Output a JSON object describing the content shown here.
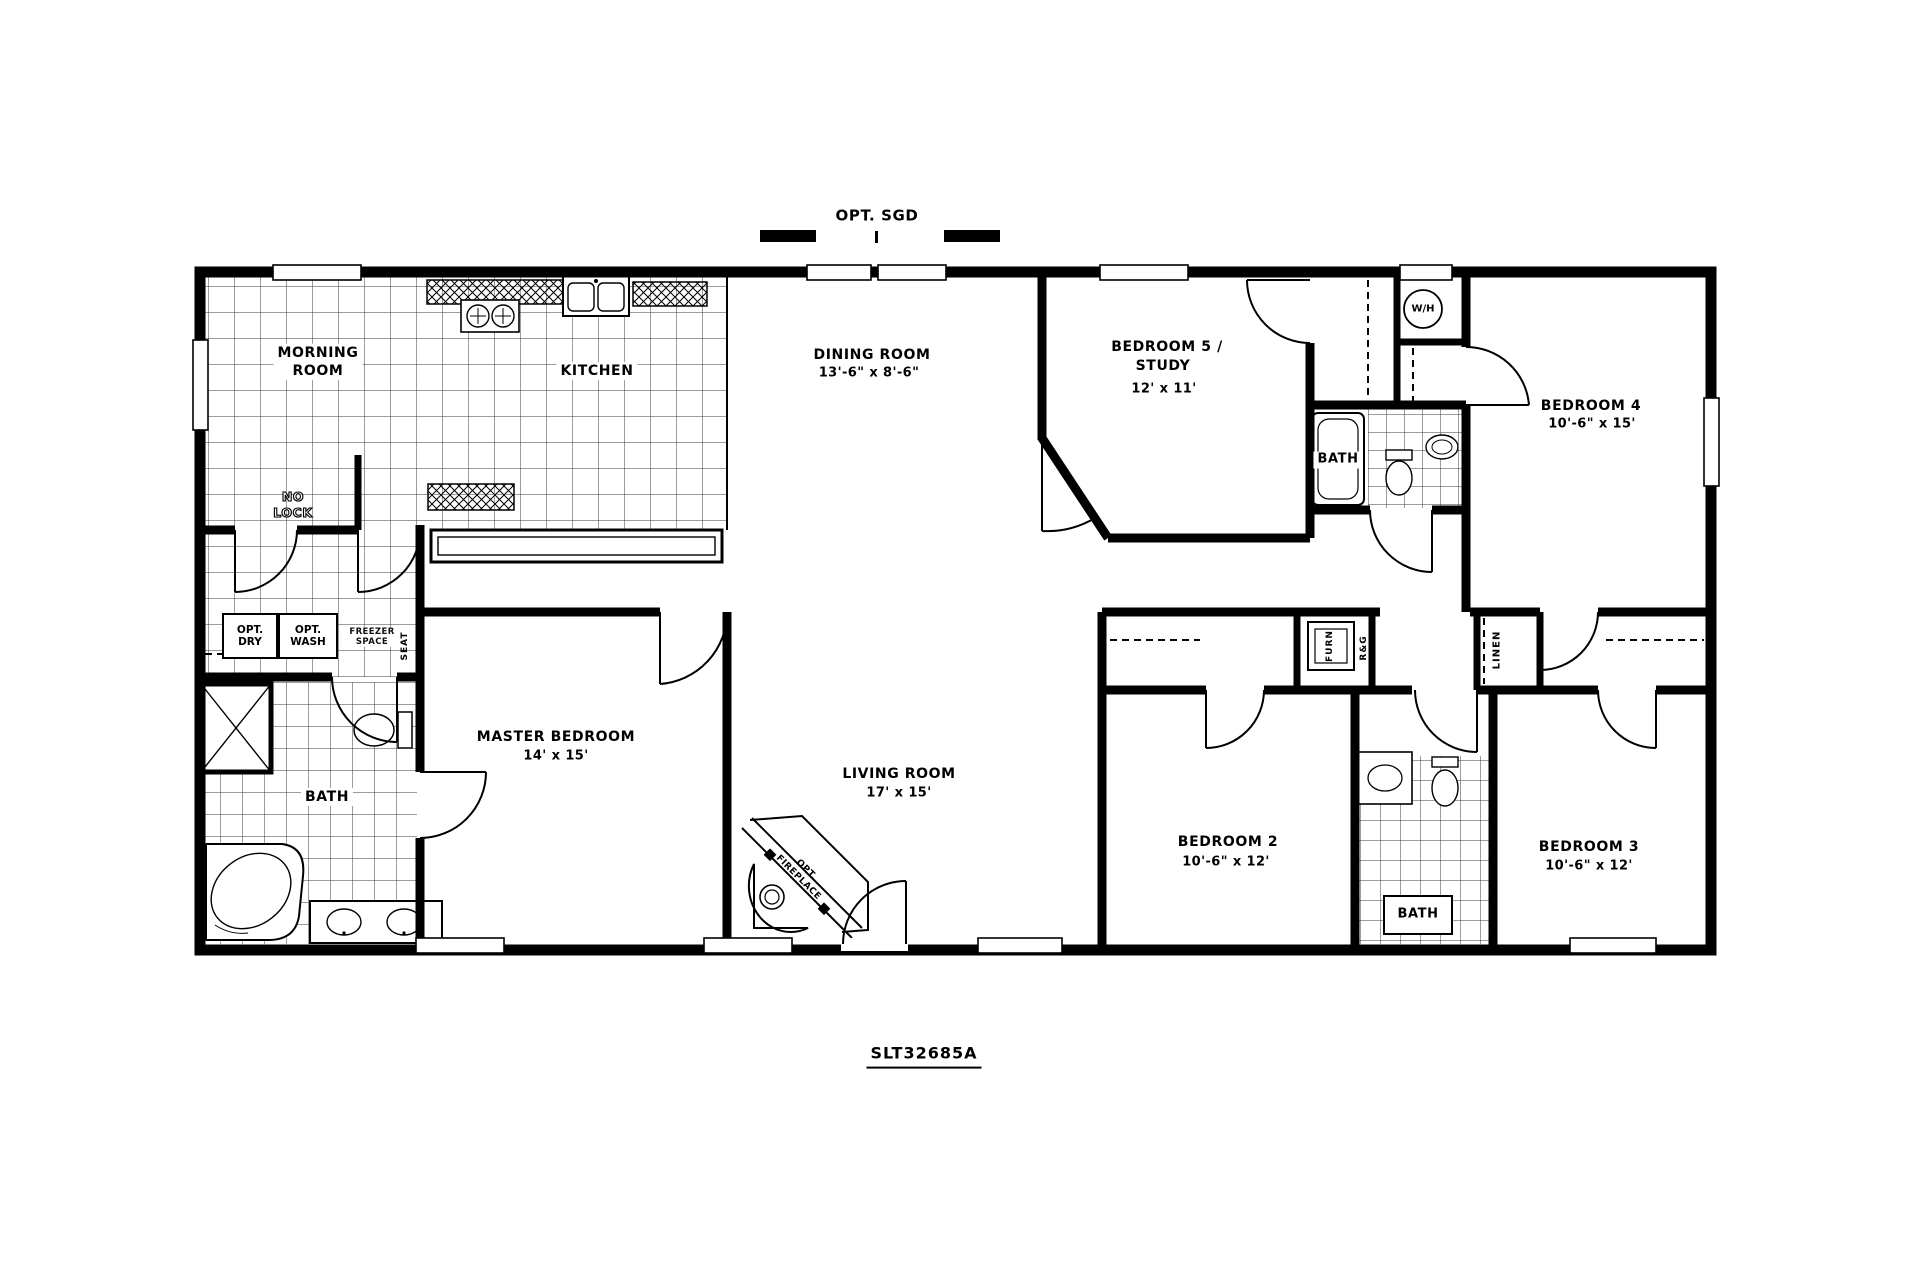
{
  "plan": {
    "title": "SLT32685A",
    "top_note": "OPT. SGD"
  },
  "rooms": {
    "morning_room": {
      "line1": "MORNING",
      "line2": "ROOM"
    },
    "kitchen": {
      "name": "KITCHEN"
    },
    "dining_room": {
      "name": "DINING ROOM",
      "dims": "13'-6\" x 8'-6\""
    },
    "living_room": {
      "name": "LIVING ROOM",
      "dims": "17' x 15'"
    },
    "master_bedroom": {
      "name": "MASTER BEDROOM",
      "dims": "14' x 15'"
    },
    "bedroom5": {
      "line1": "BEDROOM 5 /",
      "line2": "STUDY",
      "dims": "12' x 11'"
    },
    "bedroom4": {
      "name": "BEDROOM 4",
      "dims": "10'-6\" x 15'"
    },
    "bedroom2": {
      "name": "BEDROOM 2",
      "dims": "10'-6\" x 12'"
    },
    "bedroom3": {
      "name": "BEDROOM 3",
      "dims": "10'-6\" x 12'"
    },
    "master_bath": {
      "name": "BATH"
    },
    "hall_bath": {
      "name": "BATH"
    },
    "second_bath": {
      "name": "BATH"
    }
  },
  "annotations": {
    "no_lock_line1": "NO",
    "no_lock_line2": "LOCK",
    "opt_dry_line1": "OPT.",
    "opt_dry_line2": "DRY",
    "opt_wash_line1": "OPT.",
    "opt_wash_line2": "WASH",
    "freezer_line1": "FREEZER",
    "freezer_line2": "SPACE",
    "seat": "SEAT",
    "water_heater": "W/H",
    "furnace": "FURN",
    "range_gas": "R&G",
    "linen": "LINEN",
    "fireplace_line1": "OPT.",
    "fireplace_line2": "FIREPLACE"
  },
  "colors": {
    "ink": "#000000",
    "paper": "#ffffff"
  }
}
